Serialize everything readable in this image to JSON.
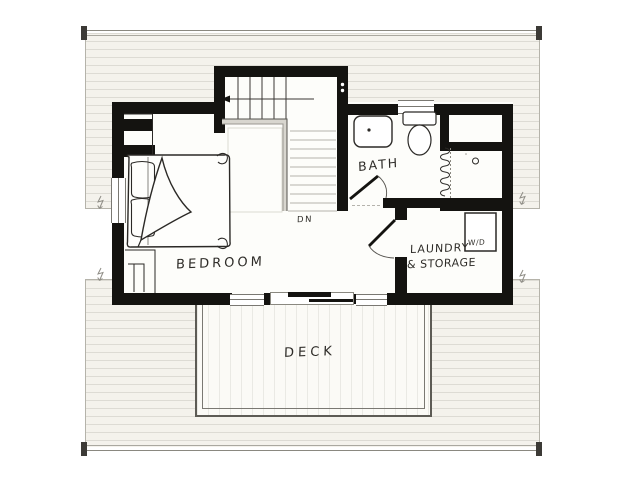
{
  "floorplan": {
    "rooms": [
      {
        "id": "bedroom",
        "label": "BEDROOM"
      },
      {
        "id": "bath",
        "label": "BATH"
      },
      {
        "id": "laundry",
        "label_line1": "LAUNDRY",
        "label_line2": "& STORAGE"
      },
      {
        "id": "deck",
        "label": "DECK"
      }
    ],
    "annotations": {
      "stairs_down": "DN",
      "washer_dryer": "W/D"
    },
    "colors": {
      "wall": "#141310",
      "ink": "#2b2926",
      "roof_fill": "#f4f2ec",
      "faint_line": "#b5b3aa",
      "paper": "#ffffff"
    }
  }
}
